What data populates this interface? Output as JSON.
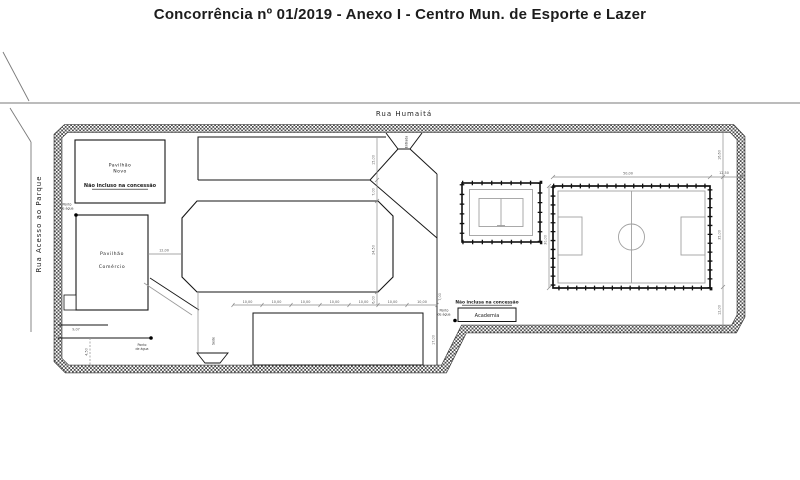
{
  "title": "Concorrência nº 01/2019 - Anexo I - Centro Mun. de Esporte e Lazer",
  "streets": {
    "top": "Rua Humaitá",
    "left": "Rua Acesso ao Parque"
  },
  "site": {
    "entrance_label": "Entrada",
    "pavilhao_novo": {
      "line1": "Pavilhão",
      "line2": "Novo",
      "note": "Não incluso na concessão"
    },
    "pavilhao_comercio": {
      "line1": "Pavilhão",
      "line2": "Comércio"
    },
    "academia": {
      "label": "Academia",
      "note": "Não inclusa na concessão"
    },
    "sede_label": "Sede",
    "water_point": {
      "line1": "Ponto",
      "line2": "de água"
    }
  },
  "dimensions": {
    "right_top": "16,60",
    "right_mid": "35,00",
    "right_bottom": "12,00",
    "field_width": "50,00",
    "field_height": "30,00",
    "field_gap": "12,50",
    "north_strip": "15,00",
    "oct_top_gap": "7,00",
    "oct_height": "24,50",
    "oct_bottom_gap": "6,00",
    "oct_left_gap": "12,00",
    "walk_width": "7,00",
    "south_height": "17,00",
    "chain": [
      "10,00",
      "10,00",
      "10,00",
      "10,00",
      "10,00",
      "10,00",
      "10,00"
    ],
    "left_a": "9,07",
    "left_b": "4,50"
  },
  "colors": {
    "line": "#161616",
    "dimension": "#8a8a8a",
    "marking": "#a0a0a0",
    "street": "#7a7a7a",
    "hatch": "#4d4d4d"
  }
}
